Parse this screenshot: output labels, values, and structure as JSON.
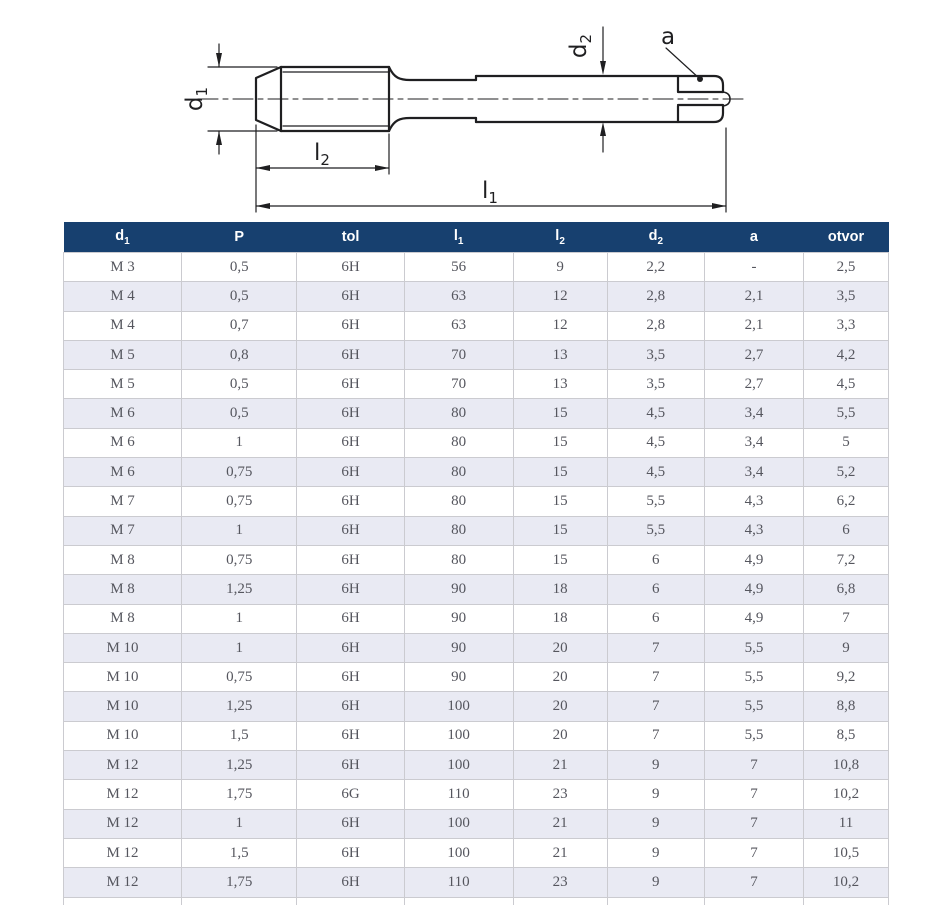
{
  "drawing": {
    "labels": {
      "d1": {
        "base": "d",
        "sub": "1"
      },
      "l2": {
        "base": "l",
        "sub": "2"
      },
      "l1": {
        "base": "l",
        "sub": "1"
      },
      "d2": {
        "base": "d",
        "sub": "2"
      },
      "a": {
        "base": "a",
        "sub": ""
      }
    }
  },
  "table": {
    "columns": [
      {
        "base": "d",
        "sub": "1"
      },
      {
        "base": "P",
        "sub": ""
      },
      {
        "base": "tol",
        "sub": ""
      },
      {
        "base": "l",
        "sub": "1"
      },
      {
        "base": "l",
        "sub": "2"
      },
      {
        "base": "d",
        "sub": "2"
      },
      {
        "base": "a",
        "sub": ""
      },
      {
        "base": "otvor",
        "sub": ""
      }
    ],
    "rows": [
      [
        "M 3",
        "0,5",
        "6H",
        "56",
        "9",
        "2,2",
        "-",
        "2,5"
      ],
      [
        "M 4",
        "0,5",
        "6H",
        "63",
        "12",
        "2,8",
        "2,1",
        "3,5"
      ],
      [
        "M 4",
        "0,7",
        "6H",
        "63",
        "12",
        "2,8",
        "2,1",
        "3,3"
      ],
      [
        "M 5",
        "0,8",
        "6H",
        "70",
        "13",
        "3,5",
        "2,7",
        "4,2"
      ],
      [
        "M 5",
        "0,5",
        "6H",
        "70",
        "13",
        "3,5",
        "2,7",
        "4,5"
      ],
      [
        "M 6",
        "0,5",
        "6H",
        "80",
        "15",
        "4,5",
        "3,4",
        "5,5"
      ],
      [
        "M 6",
        "1",
        "6H",
        "80",
        "15",
        "4,5",
        "3,4",
        "5"
      ],
      [
        "M 6",
        "0,75",
        "6H",
        "80",
        "15",
        "4,5",
        "3,4",
        "5,2"
      ],
      [
        "M 7",
        "0,75",
        "6H",
        "80",
        "15",
        "5,5",
        "4,3",
        "6,2"
      ],
      [
        "M 7",
        "1",
        "6H",
        "80",
        "15",
        "5,5",
        "4,3",
        "6"
      ],
      [
        "M 8",
        "0,75",
        "6H",
        "80",
        "15",
        "6",
        "4,9",
        "7,2"
      ],
      [
        "M 8",
        "1,25",
        "6H",
        "90",
        "18",
        "6",
        "4,9",
        "6,8"
      ],
      [
        "M 8",
        "1",
        "6H",
        "90",
        "18",
        "6",
        "4,9",
        "7"
      ],
      [
        "M 10",
        "1",
        "6H",
        "90",
        "20",
        "7",
        "5,5",
        "9"
      ],
      [
        "M 10",
        "0,75",
        "6H",
        "90",
        "20",
        "7",
        "5,5",
        "9,2"
      ],
      [
        "M 10",
        "1,25",
        "6H",
        "100",
        "20",
        "7",
        "5,5",
        "8,8"
      ],
      [
        "M 10",
        "1,5",
        "6H",
        "100",
        "20",
        "7",
        "5,5",
        "8,5"
      ],
      [
        "M 12",
        "1,25",
        "6H",
        "100",
        "21",
        "9",
        "7",
        "10,8"
      ],
      [
        "M 12",
        "1,75",
        "6G",
        "110",
        "23",
        "9",
        "7",
        "10,2"
      ],
      [
        "M 12",
        "1",
        "6H",
        "100",
        "21",
        "9",
        "7",
        "11"
      ],
      [
        "M 12",
        "1,5",
        "6H",
        "100",
        "21",
        "9",
        "7",
        "10,5"
      ],
      [
        "M 12",
        "1,75",
        "6H",
        "110",
        "23",
        "9",
        "7",
        "10,2"
      ]
    ]
  },
  "colors": {
    "header_bg": "#17406f",
    "row_alt_bg": "#e9eaf3",
    "cell_border": "#cbcbd0",
    "body_text": "#55565e",
    "header_text": "#ffffff",
    "drawing_line": "#1f1f21"
  }
}
